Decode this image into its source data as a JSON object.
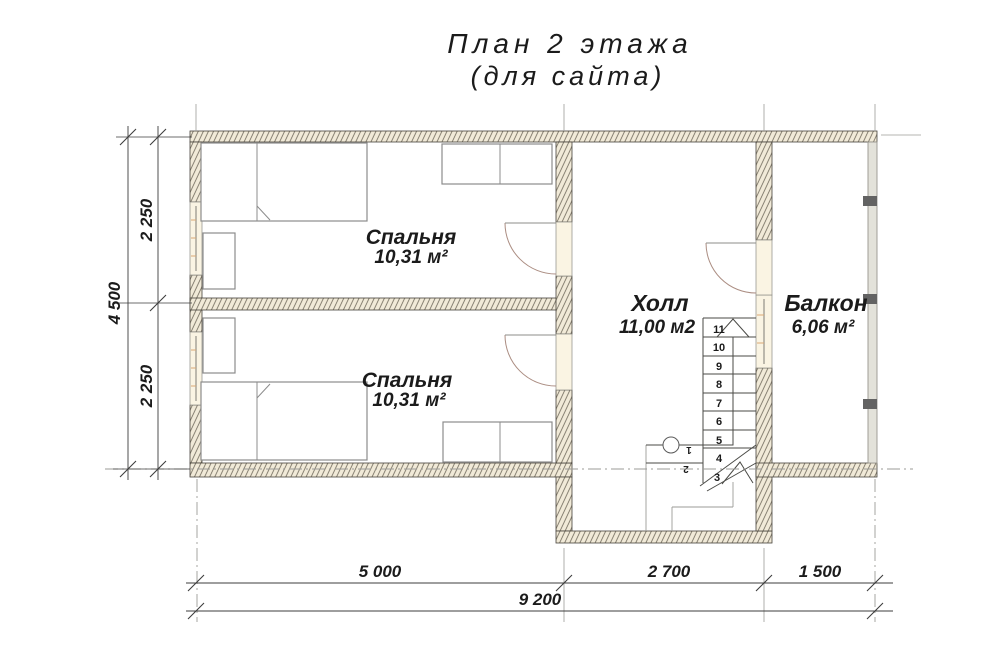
{
  "title": {
    "line1": "План 2 этажа",
    "line2": "(для сайта)"
  },
  "rooms": {
    "bedroom1": {
      "name": "Спальня",
      "area": "10,31 м²"
    },
    "bedroom2": {
      "name": "Спальня",
      "area": "10,31 м²"
    },
    "hall": {
      "name": "Холл",
      "area": "11,00 м2"
    },
    "balcony": {
      "name": "Балкон",
      "area": "6,06 м²"
    }
  },
  "dimensions": {
    "vertical": {
      "total": "4 500",
      "upper": "2 250",
      "lower": "2 250"
    },
    "horizontal": {
      "seg1": "5 000",
      "seg2": "2 700",
      "seg3": "1 500",
      "total": "9 200"
    }
  },
  "stairs": {
    "numbers": [
      "1",
      "2",
      "3",
      "4",
      "5",
      "6",
      "7",
      "8",
      "9",
      "10",
      "11"
    ]
  },
  "colors": {
    "wall_fill": "#f1ead8",
    "hatch_line": "#6e685a",
    "door_arc": "#ab8d82",
    "furniture": "#8c8c8c",
    "stair_line": "#4a4a46",
    "axis": "#9b9b97",
    "post": "#636363",
    "railing_fill": "#e3e2da",
    "dim": "#3c3c3c"
  }
}
